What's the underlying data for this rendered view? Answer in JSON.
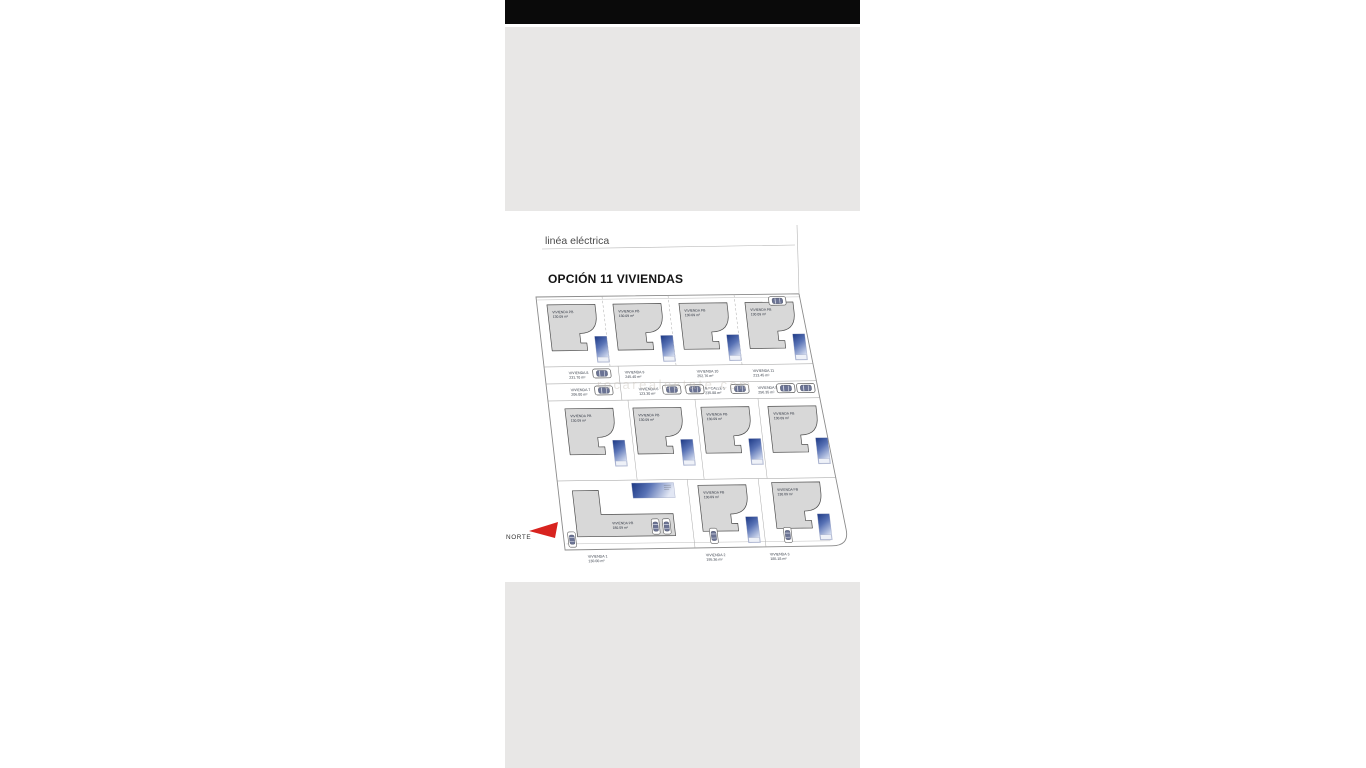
{
  "window": {
    "top_bar_color": "#0a0a0a",
    "panel_color": "#e8e7e6",
    "background": "#ffffff"
  },
  "plan": {
    "power_line_label": "linéa eléctrica",
    "title": "OPCIÓN 11 VIVIENDAS",
    "north_label": "NORTE",
    "watermark": "rocarealestate com",
    "colors": {
      "house_fill": "#d8d8d8",
      "house_outline": "#4f4f4f",
      "pool_dark": "#1c3884",
      "pool_light": "#d8e0f2",
      "north_arrow_red": "#d8231f"
    },
    "houses": [
      {
        "name": "VIVIENDA PB",
        "area": "130.09 m²"
      },
      {
        "name": "VIVIENDA PB",
        "area": "130.09 m²"
      },
      {
        "name": "VIVIENDA PB",
        "area": "130.09 m²"
      },
      {
        "name": "VIVIENDA PB",
        "area": "130.09 m²"
      },
      {
        "name": "VIVIENDA PB",
        "area": "130.09 m²"
      },
      {
        "name": "VIVIENDA PB",
        "area": "130.09 m²"
      },
      {
        "name": "VIVIENDA PB",
        "area": "130.09 m²"
      },
      {
        "name": "VIVIENDA PB",
        "area": "130.09 m²"
      },
      {
        "name": "VIVIENDA PB",
        "area": "180.09 m²"
      },
      {
        "name": "VIVIENDA PB",
        "area": "130.09 m²"
      },
      {
        "name": "VIVIENDA PB",
        "area": "130.09 m²"
      }
    ],
    "parking": {
      "left": [
        {
          "name": "VIVIENDA 8",
          "area": "231.70 m²"
        },
        {
          "name": "VIVIENDA 7",
          "area": "206.80 m²"
        }
      ],
      "top": [
        {
          "name": "VIVIENDA 9",
          "area": "245.40 m²"
        },
        {
          "name": "VIVIENDA 10",
          "area": "252.76 m²"
        },
        {
          "name": "VIVIENDA 11",
          "area": "213.45 m²"
        }
      ],
      "bottom": [
        {
          "name": "VIVIENDA 6",
          "area": "123.30 m²"
        },
        {
          "name": "N.º CALLE 1",
          "area": "235.88 m²"
        },
        {
          "name": "VIVIENDA 5",
          "area": "256.35 m²"
        }
      ]
    },
    "plots_bottom": [
      {
        "name": "VIVIENDA 1",
        "area": "130.00 m²"
      },
      {
        "name": "VIVIENDA 2",
        "area": "195.36 m²"
      },
      {
        "name": "VIVIENDA 3",
        "area": "185.18 m²"
      }
    ]
  }
}
